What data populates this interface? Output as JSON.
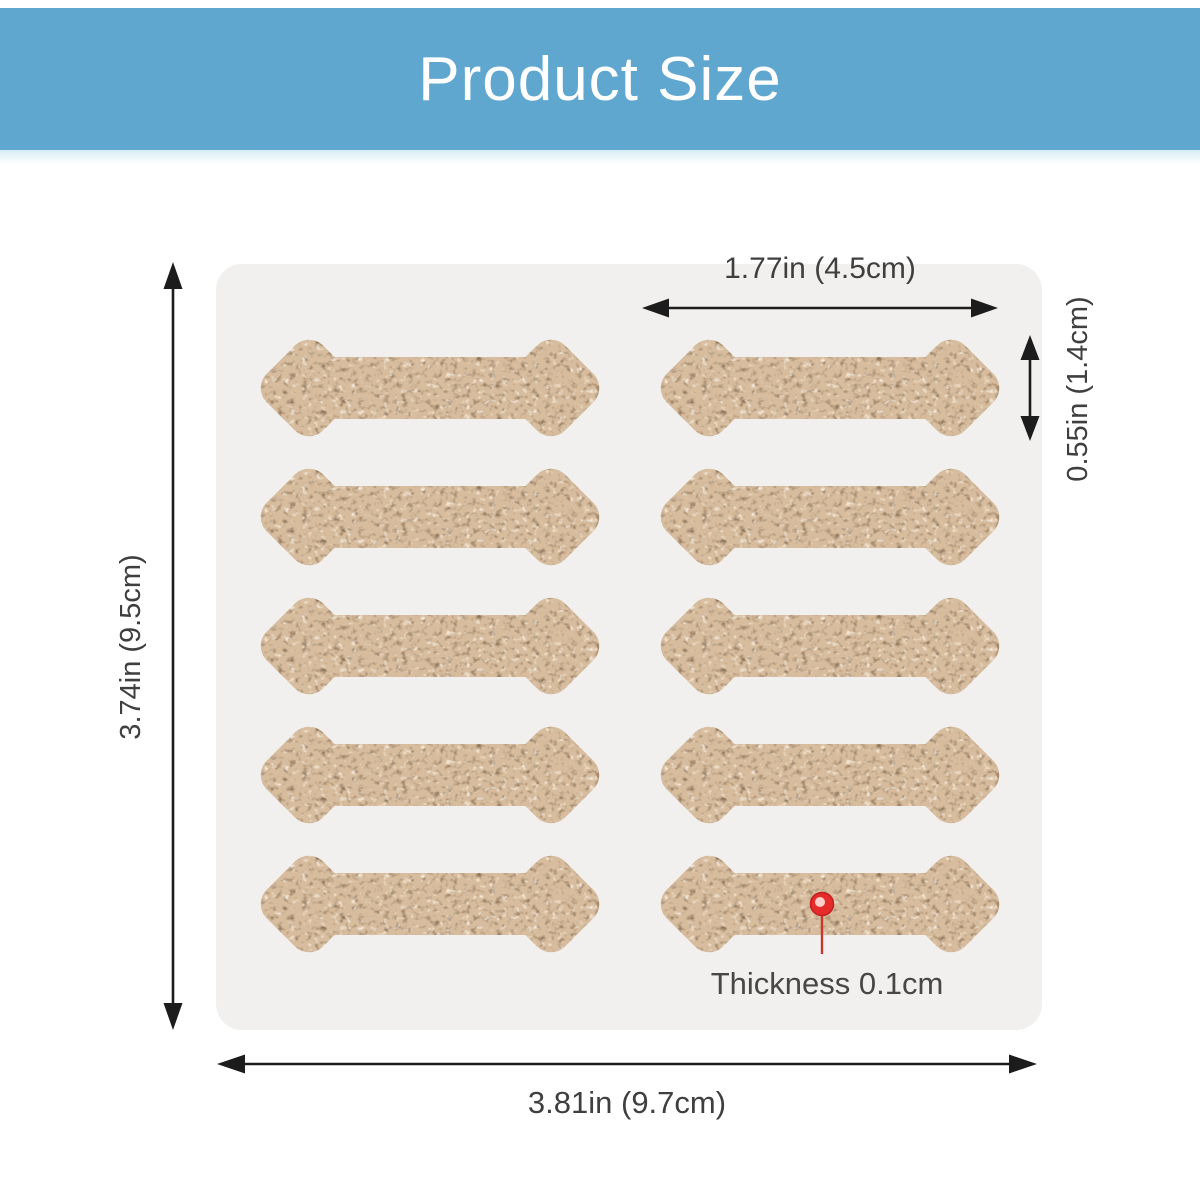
{
  "header": {
    "title": "Product Size"
  },
  "diagram": {
    "dimensions": {
      "patch_width": "1.77in (4.5cm)",
      "patch_height": "0.55in (1.4cm)",
      "sheet_height": "3.74in (9.5cm)",
      "sheet_width": "3.81in (9.7cm)",
      "thickness": "Thickness 0.1cm"
    },
    "patch_grid": {
      "rows": 5,
      "cols": 2,
      "item": "bone-shaped adhesive patch"
    }
  },
  "colors": {
    "header_bg": "#5fa7cf",
    "header_fg": "#ffffff",
    "sheet_bg": "#f1f0ee",
    "patch_base": "#d7bc9d",
    "patch_speckle_dark": "#8f7458",
    "patch_speckle_light": "#fdf5e6",
    "arrow": "#1c1c1c",
    "dimension_text": "#3f3f3f",
    "pin_red": "#e62b2b"
  }
}
